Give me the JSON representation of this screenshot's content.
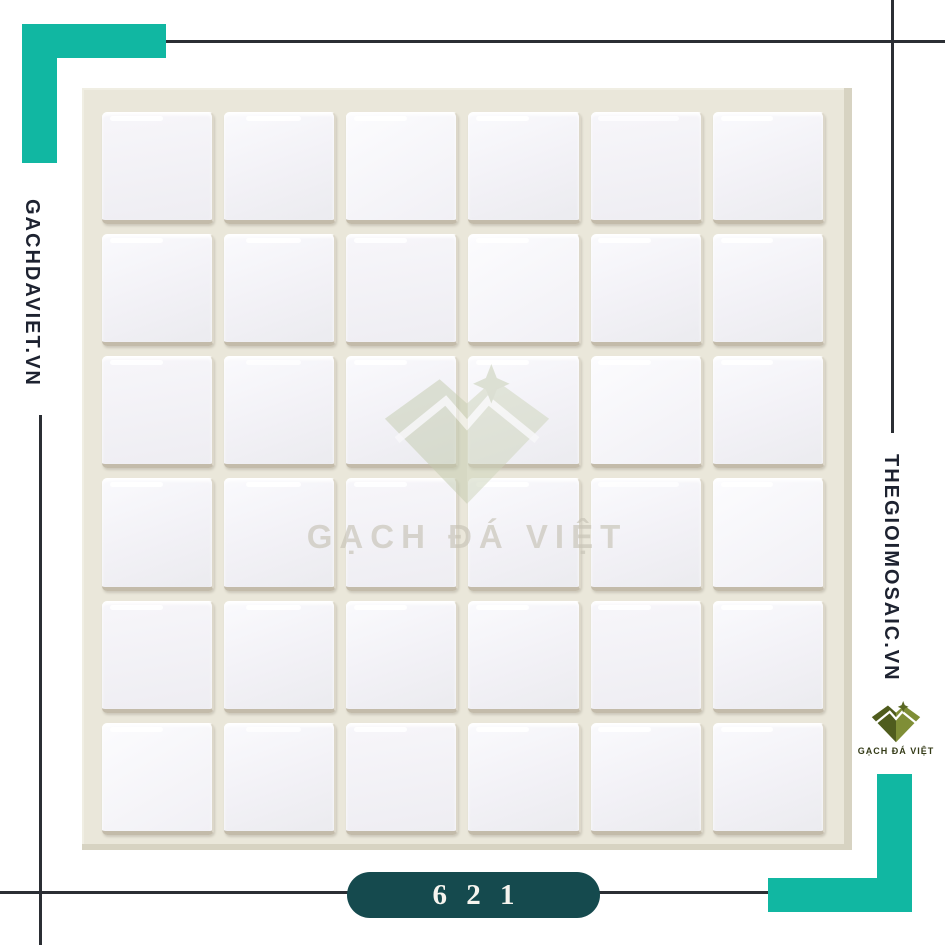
{
  "branding": {
    "left_site": "GACHDAVIET.VN",
    "right_site": "THEGIOIMOSAIC.VN",
    "watermark_text": "GẠCH ĐÁ VIỆT",
    "logo_text": "GẠCH ĐÁ VIỆT"
  },
  "badge": {
    "code": "6 2 1"
  },
  "product_photo": {
    "grid": {
      "rows": 6,
      "cols": 6
    }
  },
  "colors": {
    "accent_teal": "#11b7a2",
    "badge_background": "#154a4e",
    "rule_line": "#2b2e34",
    "text_dark": "#1d2230",
    "photo_background": "#eae7da",
    "logo_olive_dark": "#4f5c1d",
    "logo_olive_light": "#7f8e36"
  }
}
